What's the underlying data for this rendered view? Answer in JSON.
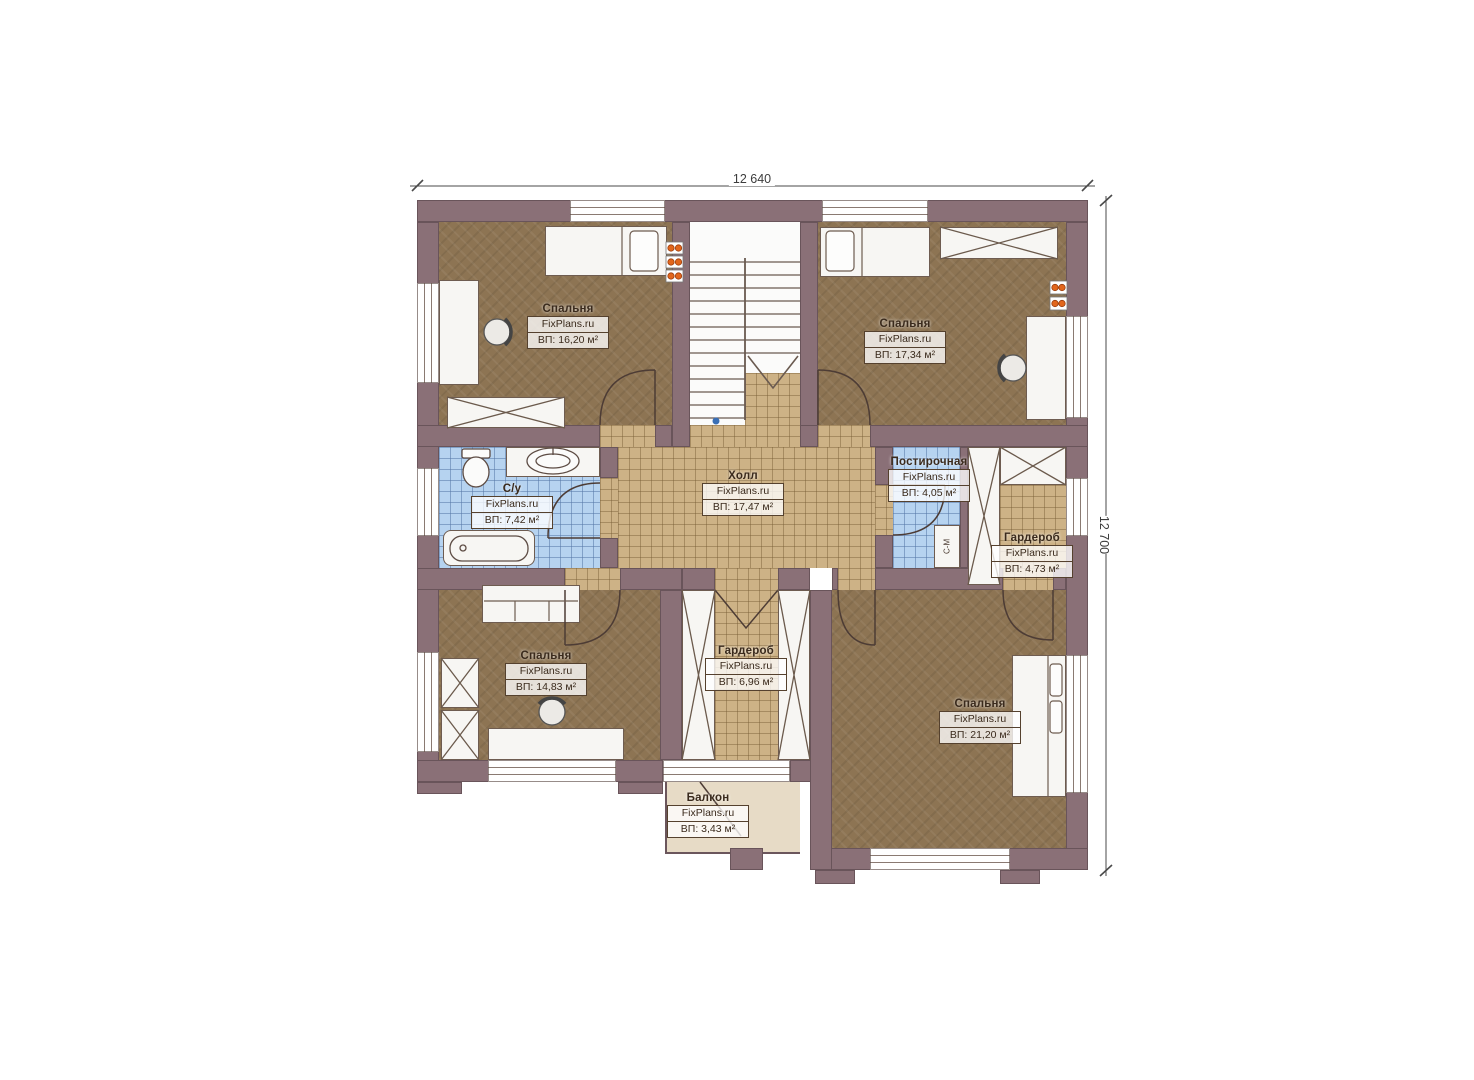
{
  "brand": "FixPlans.ru",
  "dimensions": {
    "top": "12 640",
    "right": "12 700"
  },
  "rooms": {
    "bedroom_tl": {
      "name": "Спальня",
      "area": "ВП: 16,20 м²"
    },
    "bedroom_tr": {
      "name": "Спальня",
      "area": "ВП: 17,34 м²"
    },
    "bathroom": {
      "name": "С/у",
      "area": "ВП: 7,42 м²"
    },
    "hall": {
      "name": "Холл",
      "area": "ВП: 17,47 м²"
    },
    "laundry": {
      "name": "Постирочная",
      "area": "ВП: 4,05 м²"
    },
    "wardrobe_right": {
      "name": "Гардероб",
      "area": "ВП: 4,73 м²"
    },
    "bedroom_bl": {
      "name": "Спальня",
      "area": "ВП: 14,83 м²"
    },
    "wardrobe_center": {
      "name": "Гардероб",
      "area": "ВП: 6,96 м²"
    },
    "bedroom_br": {
      "name": "Спальня",
      "area": "ВП: 21,20 м²"
    },
    "balcony": {
      "name": "Балкон",
      "area": "ВП: 3,43 м²"
    }
  },
  "appliances": {
    "washing_machine": "С-М"
  },
  "colors": {
    "wall": "#8a7077",
    "bedroom_floor": "#8d7453",
    "tile_tan": "#cdb286",
    "tile_blue": "#b6d3f0",
    "balcony_floor": "#e7dbc6",
    "lamp_accent": "#e2661c"
  }
}
